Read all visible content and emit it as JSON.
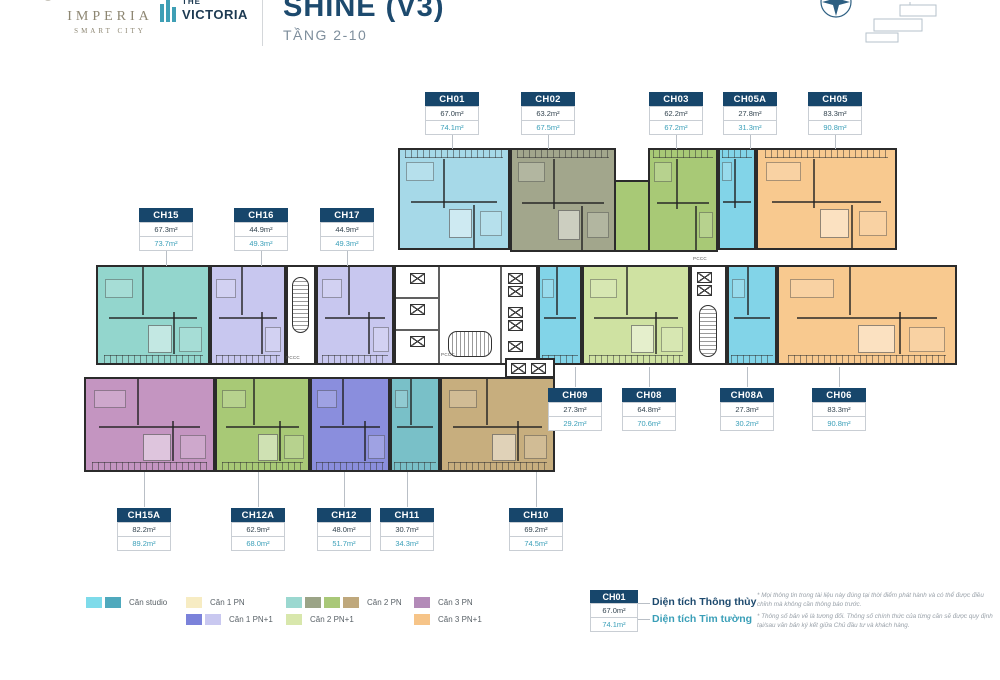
{
  "header": {
    "brand_imperia": {
      "name": "IMPERIA",
      "sub": "SMART CITY"
    },
    "brand_victoria": {
      "top": "THE",
      "name": "VICTORIA"
    },
    "title": "SHINE (V3)",
    "subtitle": "TẦNG 2-10"
  },
  "plan": {
    "core_label": "PCCC"
  },
  "units": [
    {
      "code": "CH01",
      "area_net": "67.0m²",
      "area_gross": "74.1m²",
      "category": "Căn 2 PN",
      "color": "#a6d9e8"
    },
    {
      "code": "CH02",
      "area_net": "63.2m²",
      "area_gross": "67.5m²",
      "category": "Căn 2 PN",
      "color": "#a2a68c"
    },
    {
      "code": "CH03",
      "area_net": "62.2m²",
      "area_gross": "67.2m²",
      "category": "Căn 2 PN",
      "color": "#a8c976"
    },
    {
      "code": "CH05A",
      "area_net": "27.8m²",
      "area_gross": "31.3m²",
      "category": "Căn studio",
      "color": "#82d4e8"
    },
    {
      "code": "CH05",
      "area_net": "83.3m²",
      "area_gross": "90.8m²",
      "category": "Căn 3 PN+1",
      "color": "#f8c98f"
    },
    {
      "code": "CH15",
      "area_net": "67.3m²",
      "area_gross": "73.7m²",
      "category": "Căn 2 PN",
      "color": "#93d6cd"
    },
    {
      "code": "CH16",
      "area_net": "44.9m²",
      "area_gross": "49.3m²",
      "category": "Căn 1 PN+1",
      "color": "#c8c7ef"
    },
    {
      "code": "CH17",
      "area_net": "44.9m²",
      "area_gross": "49.3m²",
      "category": "Căn 1 PN+1",
      "color": "#c8c7ef"
    },
    {
      "code": "CH09",
      "area_net": "27.3m²",
      "area_gross": "29.2m²",
      "category": "Căn studio",
      "color": "#82d4e8"
    },
    {
      "code": "CH08",
      "area_net": "64.8m²",
      "area_gross": "70.6m²",
      "category": "Căn 2 PN+1",
      "color": "#cfe2a2"
    },
    {
      "code": "CH08A",
      "area_net": "27.3m²",
      "area_gross": "30.2m²",
      "category": "Căn studio",
      "color": "#82d4e8"
    },
    {
      "code": "CH06",
      "area_net": "83.3m²",
      "area_gross": "90.8m²",
      "category": "Căn 3 PN+1",
      "color": "#f8c98f"
    },
    {
      "code": "CH15A",
      "area_net": "82.2m²",
      "area_gross": "89.2m²",
      "category": "Căn 3 PN",
      "color": "#c495c1"
    },
    {
      "code": "CH12A",
      "area_net": "62.9m²",
      "area_gross": "68.0m²",
      "category": "Căn 2 PN",
      "color": "#a8c976"
    },
    {
      "code": "CH12",
      "area_net": "48.0m²",
      "area_gross": "51.7m²",
      "category": "Căn 1 PN+1",
      "color": "#8a8edd"
    },
    {
      "code": "CH11",
      "area_net": "30.7m²",
      "area_gross": "34.3m²",
      "category": "Căn studio",
      "color": "#79c0c8"
    },
    {
      "code": "CH10",
      "area_net": "69.2m²",
      "area_gross": "74.5m²",
      "category": "Căn 2 PN",
      "color": "#c7ae7e"
    }
  ],
  "legend": {
    "items": [
      {
        "label": "Căn studio",
        "colors": [
          "#7edbea",
          "#4fa9bd"
        ]
      },
      {
        "label": "Căn 1 PN",
        "colors": [
          "#f7ecc3"
        ]
      },
      {
        "label": "Căn 1 PN+1",
        "colors": [
          "#7b82da",
          "#c9c8f0"
        ]
      },
      {
        "label": "Căn 2 PN",
        "colors": [
          "#9bd8d0",
          "#9ba487",
          "#a9c878",
          "#bfa87c"
        ]
      },
      {
        "label": "Căn 2 PN+1",
        "colors": [
          "#d8e7ac"
        ]
      },
      {
        "label": "Căn 3 PN",
        "colors": [
          "#b38ab8"
        ]
      },
      {
        "label": "Căn 3 PN+1",
        "colors": [
          "#f6c488"
        ]
      }
    ],
    "sample": {
      "code": "CH01",
      "area_net": "67.0m²",
      "area_gross": "74.1m²",
      "net_label": "Diện tích Thông thủy",
      "gross_label": "Diện tích Tim tường"
    }
  },
  "disclaimer": [
    "* Mọi thông tin trong tài liệu này đúng tại thời điểm phát hành và có thể được điều chỉnh mà không cần thông báo trước.",
    "* Thông số bản vẽ là tương đối. Thông số chính thức của từng căn sẽ được quy định tại/sau văn bản ký kết giữa Chủ đầu tư và khách hàng."
  ],
  "palette": {
    "navy": "#17466b",
    "teal_text": "#3a9fb8",
    "wall": "#2b2b2b",
    "leader_gray": "#b9bfc6"
  }
}
